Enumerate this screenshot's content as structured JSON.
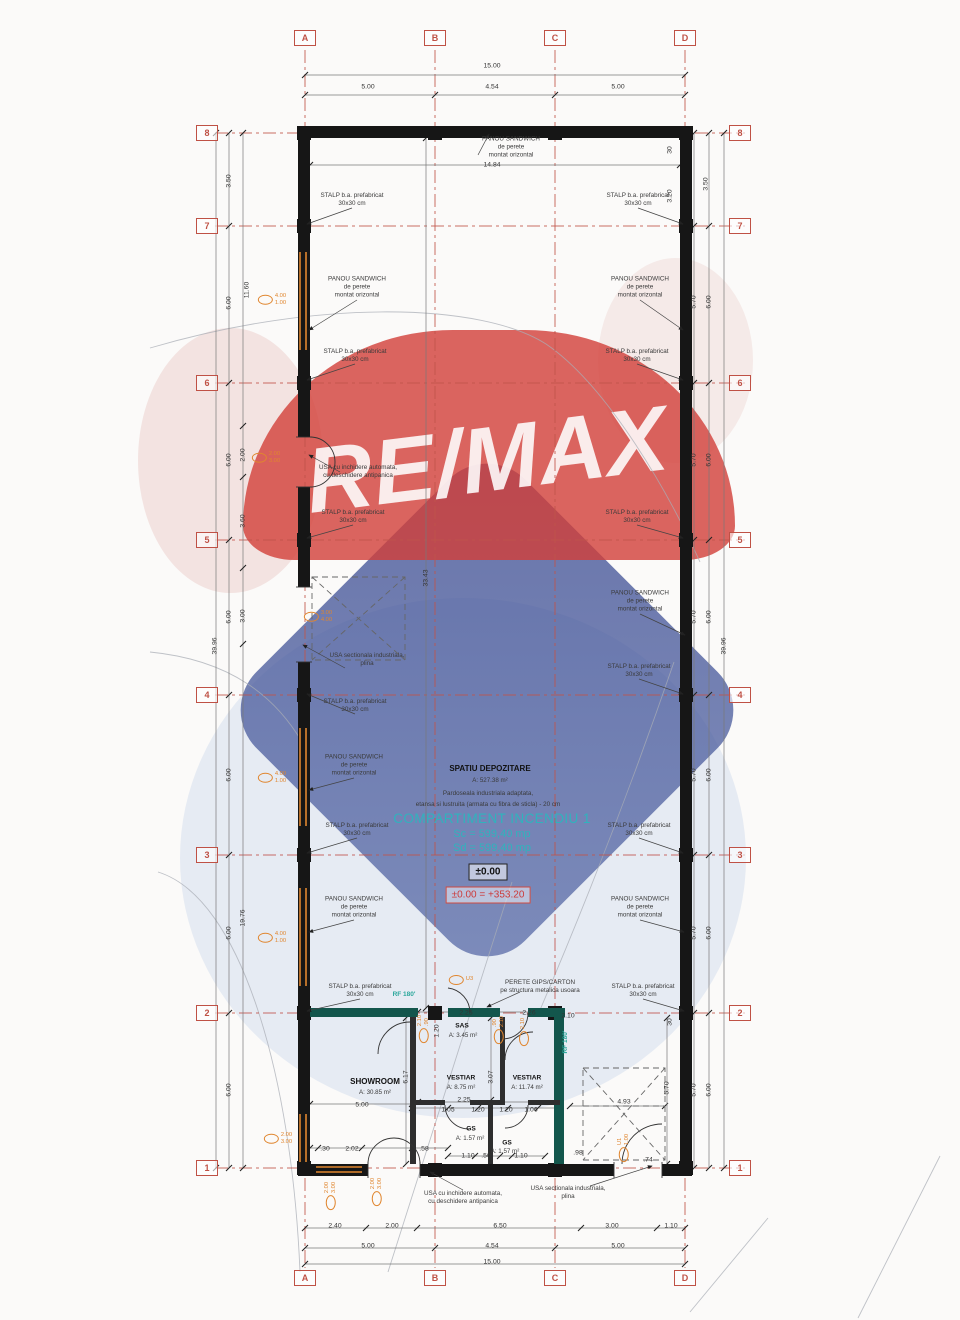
{
  "watermark": {
    "brand": "RE/MAX"
  },
  "colors": {
    "axis_red": "#c0544a",
    "wall_black": "#161616",
    "fire_wall_teal": "#13564c",
    "rf_text_teal": "#2aa79b",
    "fire_compartment_cyan": "#2fb3bd",
    "stamp_orange": "#e0862f",
    "level_red": "#cc3a3a"
  },
  "axes": {
    "cols": [
      {
        "label": "A",
        "x": 305
      },
      {
        "label": "B",
        "x": 435
      },
      {
        "label": "C",
        "x": 555
      },
      {
        "label": "D",
        "x": 685
      }
    ],
    "rows": [
      {
        "label": "8",
        "y": 133
      },
      {
        "label": "7",
        "y": 226
      },
      {
        "label": "6",
        "y": 383
      },
      {
        "label": "5",
        "y": 540
      },
      {
        "label": "4",
        "y": 695
      },
      {
        "label": "3",
        "y": 855
      },
      {
        "label": "2",
        "y": 1013
      },
      {
        "label": "1",
        "y": 1168
      }
    ]
  },
  "fire_block": {
    "room": "SPATIU DEPOZITARE",
    "room_area": "A: 527.38 m²",
    "floor_note_1": "Pardoseala industriala adaptata,",
    "floor_note_2": "etansa si lustruita (armata cu fibra de sticla) - 20 cm",
    "compartment": "COMPARTIMENT INCENDIU 1",
    "sc": "Sc = 599,40 mp",
    "sd": "Sd = 599,40 mp",
    "level": "±0.00",
    "level_eq": "±0.00 = +353.20"
  },
  "texts": [
    {
      "t": "SPATIU DEPOZITARE",
      "x": 490,
      "y": 769,
      "cls": "b"
    },
    {
      "t": "A: 527.38 m²",
      "x": 490,
      "y": 781,
      "cls": "area"
    },
    {
      "t": "Pardoseala industriala adaptata,",
      "x": 488,
      "y": 794
    },
    {
      "t": "etansa si lustruita (armata cu fibra de sticla) - 20 cm",
      "x": 488,
      "y": 805
    },
    {
      "t": "COMPARTIMENT INCENDIU 1",
      "x": 492,
      "y": 819,
      "cls": "cyL"
    },
    {
      "t": "Sc = 599,40 mp",
      "x": 492,
      "y": 834,
      "cls": "cyM"
    },
    {
      "t": "Sd = 599,40 mp",
      "x": 492,
      "y": 848,
      "cls": "cyM"
    },
    {
      "t": "±0.00",
      "x": 488,
      "y": 872,
      "cls": "lvl"
    },
    {
      "t": "±0.00 = +353.20",
      "x": 488,
      "y": 895,
      "cls": "lvlRed"
    },
    {
      "t": "SHOWROOM",
      "x": 375,
      "y": 1082,
      "cls": "b"
    },
    {
      "t": "A: 30.85 m²",
      "x": 375,
      "y": 1093,
      "cls": "area"
    },
    {
      "t": "SAS",
      "x": 462,
      "y": 1027,
      "cls": "b2"
    },
    {
      "t": "A: 3.45 m²",
      "x": 463,
      "y": 1036,
      "cls": "area"
    },
    {
      "t": "VESTIAR",
      "x": 461,
      "y": 1079,
      "cls": "b2"
    },
    {
      "t": "A: 8.75 m²",
      "x": 461,
      "y": 1088,
      "cls": "area"
    },
    {
      "t": "VESTIAR",
      "x": 527,
      "y": 1079,
      "cls": "b2"
    },
    {
      "t": "A: 11.74 m²",
      "x": 527,
      "y": 1088,
      "cls": "area"
    },
    {
      "t": "GS",
      "x": 471,
      "y": 1130,
      "cls": "b2"
    },
    {
      "t": "A: 1.57 m²",
      "x": 470,
      "y": 1139,
      "cls": "area"
    },
    {
      "t": "GS",
      "x": 507,
      "y": 1144,
      "cls": "b2"
    },
    {
      "t": "A: 1.57 m²",
      "x": 505,
      "y": 1152,
      "cls": "area"
    },
    {
      "t": "RF 180'",
      "x": 404,
      "y": 995,
      "cls": "teal"
    },
    {
      "t": "RF 180'",
      "x": 566,
      "y": 1042,
      "cls": "teal",
      "r": 1
    },
    {
      "t": "PANOU SANDWICH\nde perete\nmontat orizontal",
      "x": 511,
      "y": 148
    },
    {
      "t": "STALP b.a. prefabricat\n30x30 cm",
      "x": 352,
      "y": 200
    },
    {
      "t": "STALP b.a. prefabricat\n30x30 cm",
      "x": 638,
      "y": 200
    },
    {
      "t": "PANOU SANDWICH\nde perete\nmontat orizontal",
      "x": 357,
      "y": 288
    },
    {
      "t": "PANOU SANDWICH\nde perete\nmontat orizontal",
      "x": 640,
      "y": 288
    },
    {
      "t": "STALP b.a. prefabricat\n30x30 cm",
      "x": 355,
      "y": 356
    },
    {
      "t": "STALP b.a. prefabricat\n30x30 cm",
      "x": 637,
      "y": 356
    },
    {
      "t": "USA cu inchidere automata,\ncu deschidere antipanica",
      "x": 358,
      "y": 472
    },
    {
      "t": "STALP b.a. prefabricat\n30x30 cm",
      "x": 353,
      "y": 517
    },
    {
      "t": "STALP b.a. prefabricat\n30x30 cm",
      "x": 637,
      "y": 517
    },
    {
      "t": "PANOU SANDWICH\nde perete\nmontat orizontal",
      "x": 640,
      "y": 602
    },
    {
      "t": "USA sectionala industriala,\nplina",
      "x": 367,
      "y": 660
    },
    {
      "t": "STALP b.a. prefabricat\n30x30 cm",
      "x": 355,
      "y": 706
    },
    {
      "t": "STALP b.a. prefabricat\n30x30 cm",
      "x": 639,
      "y": 671
    },
    {
      "t": "PANOU SANDWICH\nde perete\nmontat orizontal",
      "x": 354,
      "y": 766
    },
    {
      "t": "STALP b.a. prefabricat\n30x30 cm",
      "x": 357,
      "y": 830
    },
    {
      "t": "STALP b.a. prefabricat\n30x30 cm",
      "x": 639,
      "y": 830
    },
    {
      "t": "PANOU SANDWICH\nde perete\nmontat orizontal",
      "x": 354,
      "y": 908
    },
    {
      "t": "PANOU SANDWICH\nde perete\nmontat orizontal",
      "x": 640,
      "y": 908
    },
    {
      "t": "STALP b.a. prefabricat\n30x30 cm",
      "x": 360,
      "y": 991
    },
    {
      "t": "STALP b.a. prefabricat\n30x30 cm",
      "x": 643,
      "y": 991
    },
    {
      "t": "PERETE GIPS/CARTON\npe structura metalica usoara",
      "x": 540,
      "y": 987
    },
    {
      "t": "USA cu inchidere automata,\ncu deschidere antipanica",
      "x": 463,
      "y": 1198
    },
    {
      "t": "USA sectionala industriala,\nplina",
      "x": 568,
      "y": 1193
    }
  ],
  "dims": [
    {
      "t": "15.00",
      "x": 492,
      "y": 66
    },
    {
      "t": "5.00",
      "x": 368,
      "y": 87
    },
    {
      "t": "4.54",
      "x": 492,
      "y": 87
    },
    {
      "t": "5.00",
      "x": 618,
      "y": 87
    },
    {
      "t": "14.84",
      "x": 492,
      "y": 165
    },
    {
      "t": "30",
      "x": 670,
      "y": 150,
      "r": 1
    },
    {
      "t": "3.20",
      "x": 670,
      "y": 196,
      "r": 1
    },
    {
      "t": "3.50",
      "x": 706,
      "y": 184,
      "r": 1
    },
    {
      "t": "3.50",
      "x": 229,
      "y": 181,
      "r": 1
    },
    {
      "t": "11.60",
      "x": 247,
      "y": 290,
      "r": 1
    },
    {
      "t": "6.00",
      "x": 229,
      "y": 303,
      "r": 1
    },
    {
      "t": "5.70",
      "x": 694,
      "y": 302,
      "r": 1
    },
    {
      "t": "6.00",
      "x": 709,
      "y": 302,
      "r": 1
    },
    {
      "t": "2.00",
      "x": 243,
      "y": 455,
      "r": 1
    },
    {
      "t": "6.00",
      "x": 229,
      "y": 460,
      "r": 1
    },
    {
      "t": "5.70",
      "x": 694,
      "y": 460,
      "r": 1
    },
    {
      "t": "6.00",
      "x": 709,
      "y": 460,
      "r": 1
    },
    {
      "t": "3.60",
      "x": 243,
      "y": 521,
      "r": 1
    },
    {
      "t": "3.00",
      "x": 243,
      "y": 616,
      "r": 1
    },
    {
      "t": "6.00",
      "x": 229,
      "y": 617,
      "r": 1
    },
    {
      "t": "5.70",
      "x": 694,
      "y": 617,
      "r": 1
    },
    {
      "t": "6.00",
      "x": 709,
      "y": 617,
      "r": 1
    },
    {
      "t": "39.96",
      "x": 215,
      "y": 646,
      "r": 1
    },
    {
      "t": "39.96",
      "x": 724,
      "y": 646,
      "r": 1
    },
    {
      "t": "33.43",
      "x": 426,
      "y": 578,
      "r": 1
    },
    {
      "t": "6.00",
      "x": 229,
      "y": 775,
      "r": 1
    },
    {
      "t": "5.70",
      "x": 694,
      "y": 775,
      "r": 1
    },
    {
      "t": "6.00",
      "x": 709,
      "y": 775,
      "r": 1
    },
    {
      "t": "19.76",
      "x": 243,
      "y": 918,
      "r": 1
    },
    {
      "t": "6.00",
      "x": 229,
      "y": 933,
      "r": 1
    },
    {
      "t": "5.70",
      "x": 694,
      "y": 933,
      "r": 1
    },
    {
      "t": "6.00",
      "x": 709,
      "y": 933,
      "r": 1
    },
    {
      "t": "30",
      "x": 670,
      "y": 1022,
      "r": 1
    },
    {
      "t": "6.00",
      "x": 229,
      "y": 1090,
      "r": 1
    },
    {
      "t": "5.70",
      "x": 694,
      "y": 1090,
      "r": 1
    },
    {
      "t": "6.00",
      "x": 709,
      "y": 1090,
      "r": 1
    },
    {
      "t": "2.25",
      "x": 466,
      "y": 1013
    },
    {
      "t": "2.26",
      "x": 529,
      "y": 1013
    },
    {
      "t": "2.10",
      "x": 568,
      "y": 1016
    },
    {
      "t": "1.20",
      "x": 437,
      "y": 1031,
      "r": 1
    },
    {
      "t": "6.17",
      "x": 406,
      "y": 1077,
      "r": 1
    },
    {
      "t": "3.07",
      "x": 491,
      "y": 1077,
      "r": 1
    },
    {
      "t": "5.70",
      "x": 667,
      "y": 1088,
      "r": 1
    },
    {
      "t": "5.00",
      "x": 362,
      "y": 1105
    },
    {
      "t": "2.25",
      "x": 464,
      "y": 1100
    },
    {
      "t": "4.93",
      "x": 624,
      "y": 1102
    },
    {
      "t": "1.05",
      "x": 448,
      "y": 1110
    },
    {
      "t": "1.20",
      "x": 478,
      "y": 1110
    },
    {
      "t": "1.20",
      "x": 506,
      "y": 1110
    },
    {
      "t": "1.06",
      "x": 531,
      "y": 1110
    },
    {
      "t": ".30",
      "x": 325,
      "y": 1149
    },
    {
      "t": "2.02",
      "x": 352,
      "y": 1149
    },
    {
      "t": ".58",
      "x": 424,
      "y": 1149
    },
    {
      "t": ".98",
      "x": 578,
      "y": 1153
    },
    {
      "t": "1.10",
      "x": 468,
      "y": 1156
    },
    {
      "t": ".50",
      "x": 486,
      "y": 1156
    },
    {
      "t": "1.10",
      "x": 521,
      "y": 1156
    },
    {
      "t": ".74",
      "x": 648,
      "y": 1160
    },
    {
      "t": "2.40",
      "x": 335,
      "y": 1226
    },
    {
      "t": "2.00",
      "x": 392,
      "y": 1226
    },
    {
      "t": "6.50",
      "x": 500,
      "y": 1226
    },
    {
      "t": "3.00",
      "x": 612,
      "y": 1226
    },
    {
      "t": "1.10",
      "x": 671,
      "y": 1226
    },
    {
      "t": "5.00",
      "x": 368,
      "y": 1246
    },
    {
      "t": "4.54",
      "x": 492,
      "y": 1246
    },
    {
      "t": "5.00",
      "x": 618,
      "y": 1246
    },
    {
      "t": "15.00",
      "x": 492,
      "y": 1262
    }
  ],
  "stamps": [
    {
      "l": [
        "4.00",
        "1.00"
      ],
      "x": 272,
      "y": 300
    },
    {
      "l": [
        "2.00",
        "3.00"
      ],
      "x": 266,
      "y": 458
    },
    {
      "l": [
        "3.00",
        "4.00"
      ],
      "x": 318,
      "y": 617
    },
    {
      "l": [
        "4.00",
        "1.00"
      ],
      "x": 272,
      "y": 778
    },
    {
      "l": [
        "4.00",
        "1.00"
      ],
      "x": 272,
      "y": 938
    },
    {
      "l": [
        "2.00",
        "3.00"
      ],
      "x": 278,
      "y": 1139
    },
    {
      "l": [
        "2.00",
        "3.00"
      ],
      "x": 331,
      "y": 1196,
      "r": 1
    },
    {
      "l": [
        "2.00",
        "3.00"
      ],
      "x": 377,
      "y": 1192,
      "r": 1
    },
    {
      "l": [
        "2.10",
        ".90"
      ],
      "x": 424,
      "y": 1029,
      "r": 1
    },
    {
      "l": [
        ".90",
        "2.10"
      ],
      "x": 499,
      "y": 1030,
      "r": 1
    },
    {
      "l": [
        "2.10"
      ],
      "x": 524,
      "y": 1032,
      "r": 1
    },
    {
      "l": [
        "U3"
      ],
      "x": 461,
      "y": 980
    },
    {
      "l": [
        "U1",
        "1.00"
      ],
      "x": 624,
      "y": 1148,
      "r": 1
    }
  ]
}
